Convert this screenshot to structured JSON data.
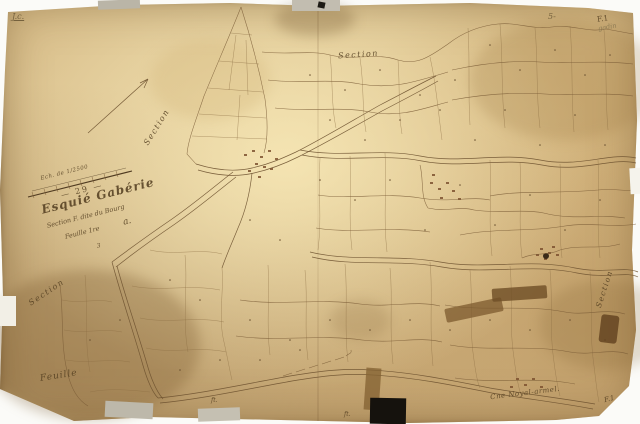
{
  "document": {
    "kind": "scanned antique cadastral map sheet",
    "colors": {
      "scan_background": "#fbfbf8",
      "paper": "#dcc393",
      "paper_edge": "#b8945f",
      "ink": "#6f5533",
      "handwriting": "#554022",
      "tape_gray": "#bcb7a9",
      "tape_brown": "#8a6a3c",
      "patch_black": "#17130e"
    }
  },
  "labels": {
    "section_top": "Section",
    "section_upper_left": "Section",
    "section_lower_left": "Section",
    "section_right": "Section",
    "feuille_bottom_left": "Feuille",
    "commune_bottom_right": "Cne Noyal-armel.",
    "sheet_bottom_right": "F.1",
    "sheet_top_right": "F.1",
    "pencil_top_right": "gadin",
    "pencil_top_left": "J.c.",
    "number_top_right": "5-",
    "mark_bottom_1": "ft.",
    "mark_bottom_2": "ft."
  },
  "title_block": {
    "scale": "Ech. de 1/2500",
    "number": "— 29 —",
    "name": "Esquié Gabérie",
    "section_line": "Section F. dite du Bourg",
    "sheet_line": "Feuille 1re",
    "suffix": "a.",
    "note": "3"
  }
}
